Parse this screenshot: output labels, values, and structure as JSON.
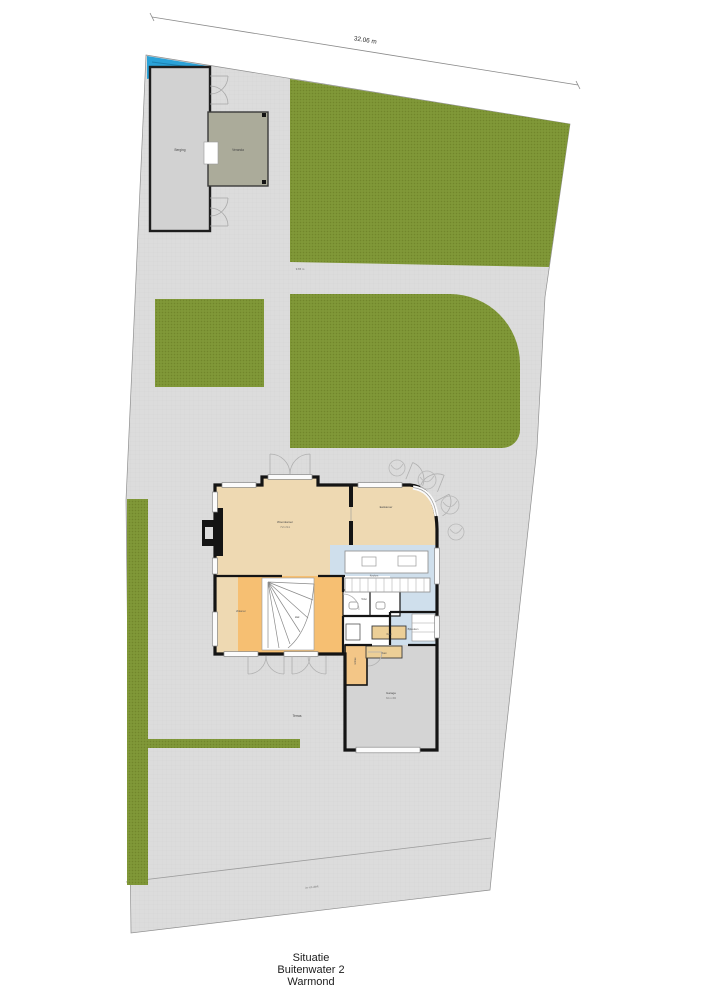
{
  "title": {
    "drawing_type": "Situatie",
    "address": "Buitenwater 2",
    "city": "Warmond"
  },
  "dimensions": {
    "plot_width": "32.06 m",
    "garden_depth": "9.65 m",
    "driveway_note": "in- en uitrit"
  },
  "outbuildings": {
    "shed": "Berging",
    "veranda": "Veranda"
  },
  "garden": {
    "terrace": "Terras"
  },
  "rooms": {
    "woonkamer": {
      "label": "Woonkamer",
      "dims": "7.2 x 9.1"
    },
    "eetkamer": {
      "label": "Eetkamer"
    },
    "keuken": {
      "label": "Keuken"
    },
    "bijkeuken": {
      "label": "Bijkeuken"
    },
    "toilet": {
      "label": "Toilet"
    },
    "hal": {
      "label": "Hal"
    },
    "zitkamer": {
      "label": "Zitkamer"
    },
    "entree": {
      "label": "Entree"
    },
    "kast1": {
      "label": "Kast"
    },
    "kast2": {
      "label": "Kast"
    },
    "garage": {
      "label": "Garage",
      "dims": "6.1 x 3.6"
    }
  },
  "colors": {
    "paving": "#dcdcdc",
    "grass": "#7d9435",
    "water": "#2aa2d8",
    "wall": "#141414",
    "floor_living": "#eed9b2",
    "floor_hall": "#f6bf72",
    "floor_kitchen": "#cfdfec",
    "floor_garage": "#d4d4d4",
    "shed_fill": "#d2d2d2",
    "veranda_fill": "#abab9a"
  }
}
